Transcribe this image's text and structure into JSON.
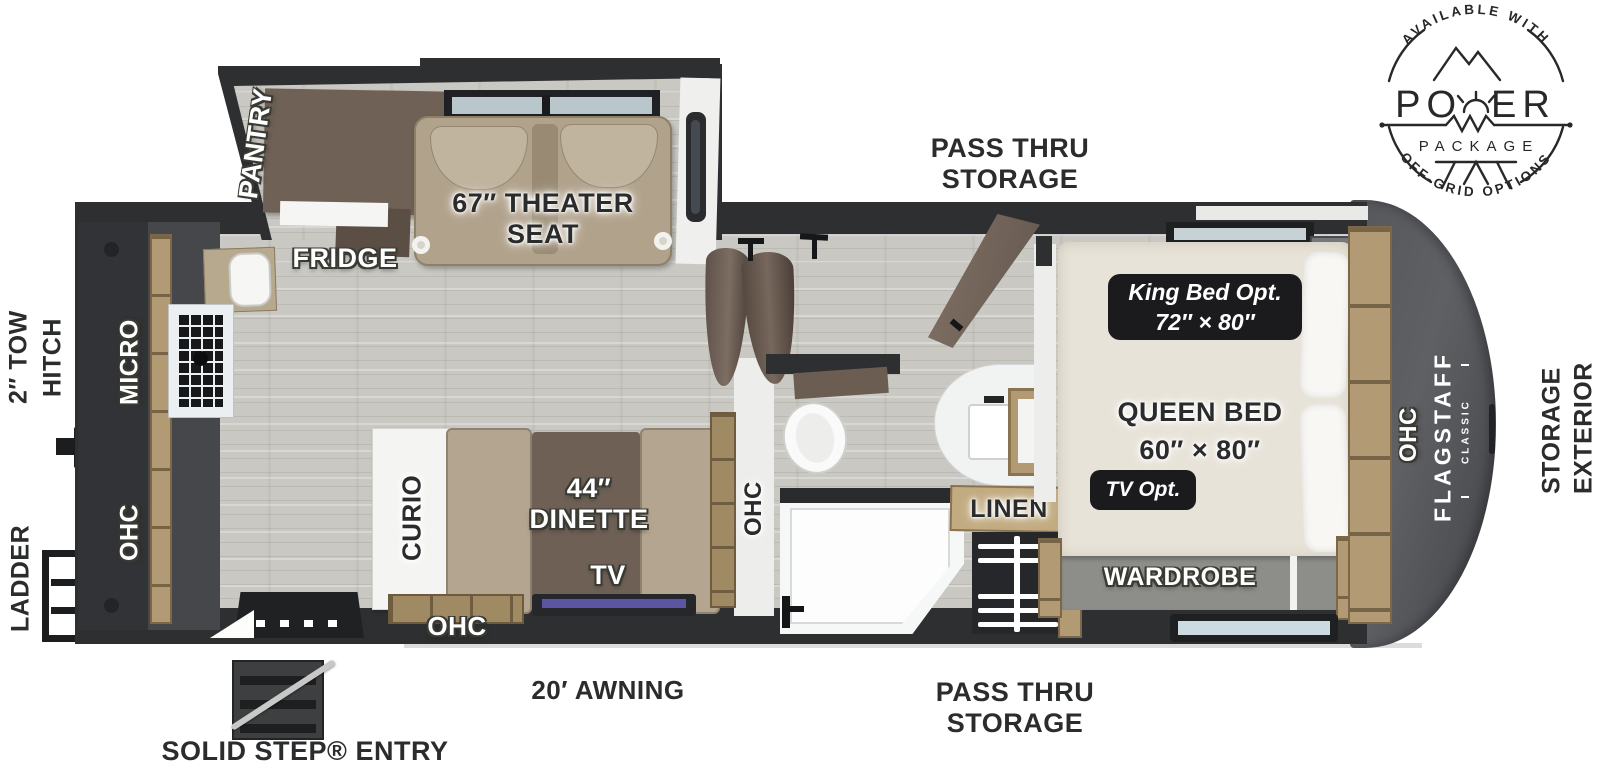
{
  "logo": {
    "top_arc": "AVAILABLE WITH",
    "power_left": "PO",
    "power_right": "ER",
    "package": "PACKAGE",
    "bottom_arc": "OFF-GRID OPTIONS"
  },
  "labels": {
    "pass_thru_top": [
      "PASS THRU",
      "STORAGE"
    ],
    "pass_thru_bottom": [
      "PASS THRU",
      "STORAGE"
    ],
    "awning": "20′ AWNING",
    "solid_step_entry": "SOLID STEP® ENTRY",
    "tow_hitch": [
      "2″ TOW",
      "HITCH"
    ],
    "ladder": "LADDER",
    "exterior_storage": [
      "EXTERIOR",
      "STORAGE"
    ]
  },
  "rooms": {
    "slideout": {
      "pantry": "PANTRY",
      "fridge": "FRIDGE",
      "theater_seat": [
        "67″ THEATER",
        "SEAT"
      ]
    },
    "kitchen": {
      "micro": "MICRO",
      "ohc": "OHC"
    },
    "living": {
      "curio": "CURIO",
      "dinette": [
        "44″",
        "DINETTE"
      ],
      "tv": "TV",
      "ohc_bottom": "OHC",
      "ohc_side": "OHC"
    },
    "bathroom": {
      "linen": "LINEN"
    },
    "bedroom": {
      "king_option": [
        "King Bed Opt.",
        "72″ × 80″"
      ],
      "queen_bed": [
        "QUEEN BED",
        "60″ × 80″"
      ],
      "tv_option": "TV Opt.",
      "wardrobe": "WARDROBE",
      "ohc": "OHC"
    },
    "brand": {
      "name": "FLAGSTAFF",
      "series": "CLASSIC"
    }
  },
  "colors": {
    "wall": "#2e2f31",
    "floor": "#c9c8c2",
    "wood_trim": "#b29a74",
    "upholstery": "#b3a58f",
    "cabinet_brown": "#6f6156",
    "badge": "#1b1b1d",
    "tv_screen": "#5c55a4",
    "front_cap": "#54565a"
  }
}
